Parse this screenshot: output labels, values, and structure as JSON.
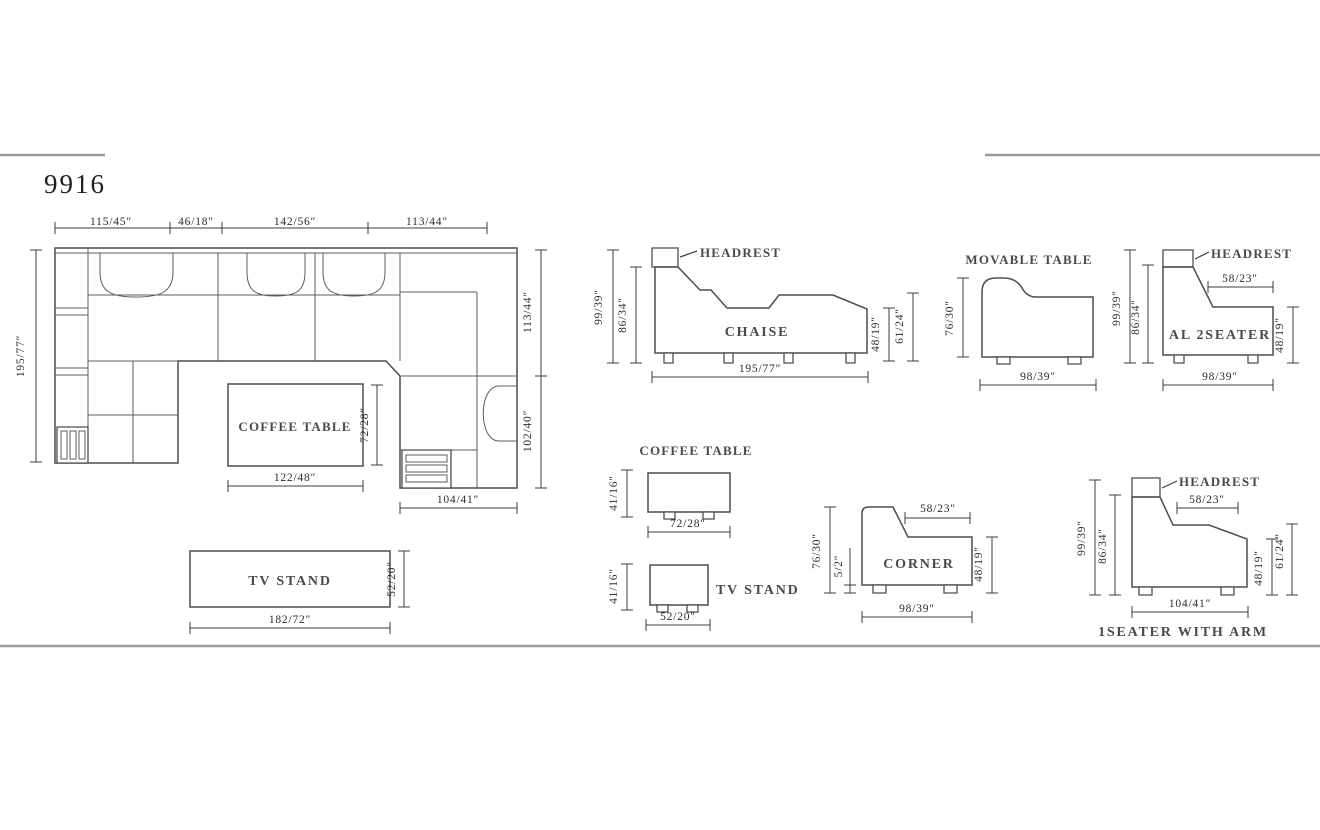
{
  "title": "9916",
  "plan": {
    "dim_top_1": "115/45″",
    "dim_top_2": "46/18″",
    "dim_top_3": "142/56″",
    "dim_top_4": "113/44″",
    "dim_left": "195/77″",
    "dim_right_upper": "113/44″",
    "dim_right_lower": "102/40″",
    "coffee_table_label": "COFFEE TABLE",
    "coffee_table_width": "122/48″",
    "coffee_table_depth": "72/28″",
    "corner_section_width": "104/41″",
    "tv_stand_label": "TV STAND",
    "tv_stand_width": "182/72″",
    "tv_stand_depth": "52/20″"
  },
  "chaise": {
    "label": "CHAISE",
    "headrest": "HEADREST",
    "height": "99/39″",
    "back_height": "86/34″",
    "seat_height": "48/19″",
    "arm_height": "61/24″",
    "width": "195/77″"
  },
  "movable_table": {
    "label": "MOVABLE TABLE",
    "height": "76/30″",
    "width": "98/39″"
  },
  "al_2seater": {
    "label": "AL 2SEATER",
    "headrest": "HEADREST",
    "height": "99/39″",
    "back_height": "86/34″",
    "seat_depth": "58/23″",
    "seat_height": "48/19″",
    "width": "98/39″"
  },
  "coffee_table_side": {
    "label": "COFFEE TABLE",
    "height": "41/16″",
    "width": "72/28″"
  },
  "tv_stand_side": {
    "label": "TV STAND",
    "height": "41/16″",
    "width": "52/20″"
  },
  "corner": {
    "label": "CORNER",
    "height": "76/30″",
    "foot_height": "5/2″",
    "seat_depth": "58/23″",
    "seat_height": "48/19″",
    "width": "98/39″"
  },
  "one_seater_arm": {
    "label": "1SEATER WITH ARM",
    "headrest": "HEADREST",
    "height": "99/39″",
    "back_height": "86/34″",
    "seat_depth": "58/23″",
    "seat_height": "48/19″",
    "arm_height": "61/24″",
    "width": "104/41″"
  }
}
